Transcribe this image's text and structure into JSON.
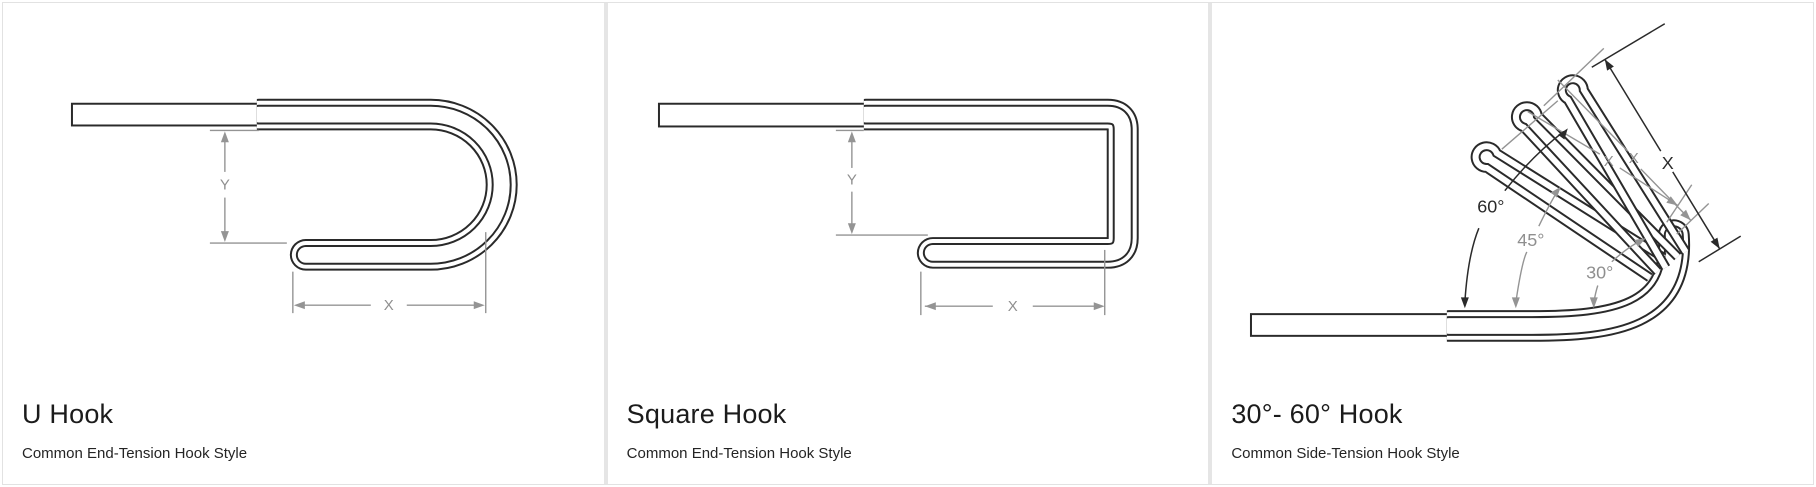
{
  "panels": [
    {
      "title": "U Hook",
      "subtitle": "Common End-Tension Hook Style",
      "dim_x": "X",
      "dim_y": "Y"
    },
    {
      "title": "Square Hook",
      "subtitle": "Common End-Tension Hook Style",
      "dim_x": "X",
      "dim_y": "Y"
    },
    {
      "title": "30°- 60° Hook",
      "subtitle": "Common Side-Tension Hook Style",
      "dim_x": "X",
      "ghost_dim_45": "X",
      "ghost_dim_30": "X",
      "angle_60": "60°",
      "angle_45": "45°",
      "angle_30": "30°"
    }
  ],
  "colors": {
    "wire_line": "#2a2a2a",
    "dimension_gray": "#949494",
    "card_background": "#ffffff",
    "divider": "#e5e5e5",
    "title_text": "#1b1b1b",
    "subtitle_text": "#242424"
  }
}
